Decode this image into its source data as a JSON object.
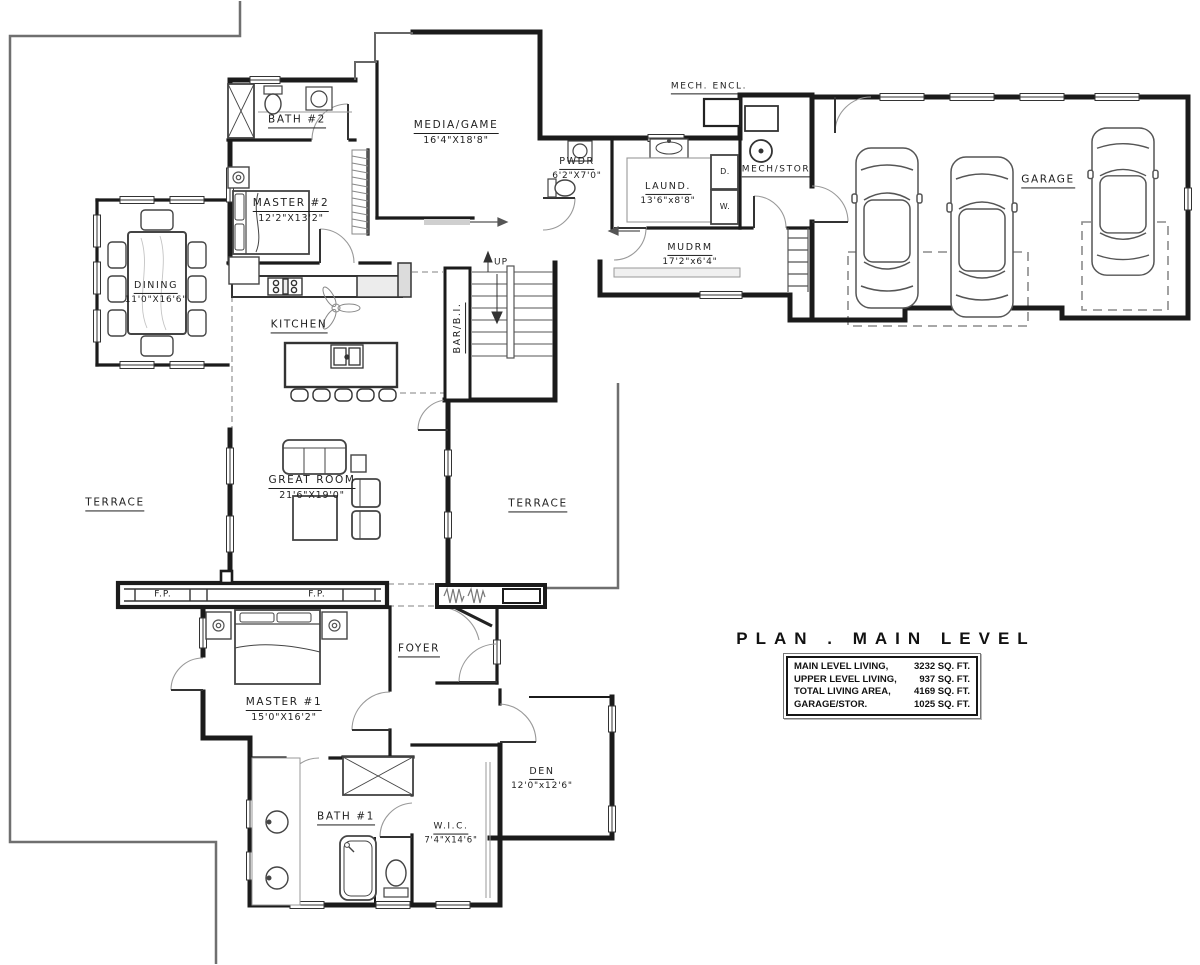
{
  "title": "PLAN . MAIN LEVEL",
  "area_table": {
    "rows": [
      {
        "label": "MAIN LEVEL LIVING,",
        "value": "3232 SQ. FT."
      },
      {
        "label": "UPPER LEVEL LIVING,",
        "value": "937 SQ. FT."
      },
      {
        "label": "TOTAL LIVING AREA,",
        "value": "4169 SQ. FT."
      },
      {
        "label": "GARAGE/STOR.",
        "value": "1025 SQ. FT."
      }
    ]
  },
  "rooms": {
    "bath_2": {
      "name": "BATH #2"
    },
    "media_game": {
      "name": "MEDIA/GAME",
      "dims": "16'4\"X18'8\""
    },
    "mech_encl": {
      "name": "MECH. ENCL."
    },
    "powder": {
      "name": "PWDR",
      "dims": "6'2\"X7'0\""
    },
    "laundry": {
      "name": "LAUND.",
      "dims": "13'6\"x8'8\""
    },
    "mech_stor": {
      "name": "MECH/STOR"
    },
    "garage": {
      "name": "GARAGE"
    },
    "master_2": {
      "name": "MASTER #2",
      "dims": "12'2\"X13'2\""
    },
    "mudroom": {
      "name": "MUDRM",
      "dims": "17'2\"x6'4\""
    },
    "dining": {
      "name": "DINING",
      "dims": "11'0\"X16'6\""
    },
    "kitchen": {
      "name": "KITCHEN"
    },
    "bar": {
      "name": "BAR/B.I."
    },
    "terrace_left": {
      "name": "TERRACE"
    },
    "terrace_right": {
      "name": "TERRACE"
    },
    "great_room": {
      "name": "GREAT ROOM",
      "dims": "21'6\"X19'0\""
    },
    "foyer": {
      "name": "FOYER"
    },
    "master_1": {
      "name": "MASTER #1",
      "dims": "15'0\"X16'2\""
    },
    "den": {
      "name": "DEN",
      "dims": "12'0\"x12'6\""
    },
    "bath_1": {
      "name": "BATH #1"
    },
    "wic": {
      "name": "W.I.C.",
      "dims": "7'4\"X14'6\""
    }
  },
  "annotations": {
    "stairs_up": "UP",
    "fireplace_left": "F.P.",
    "fireplace_right": "F.P.",
    "dryer": "D.",
    "washer": "W."
  },
  "colors": {
    "wall": "#1b1b1b",
    "line_medium": "#555555",
    "line_light": "#8a8a8a",
    "dashed": "#9a9a9a",
    "text": "#1f1f1f",
    "paper": "#ffffff"
  }
}
